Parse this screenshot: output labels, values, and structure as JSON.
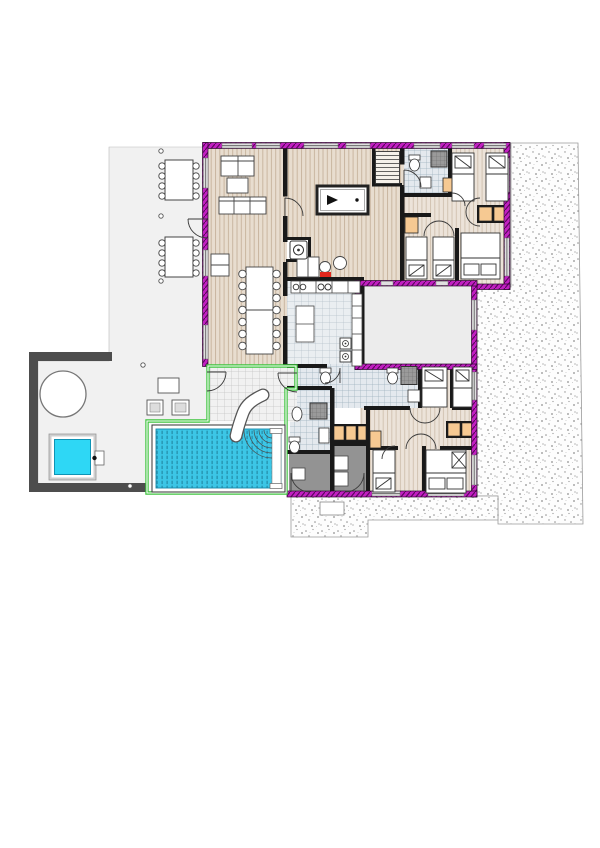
{
  "document": {
    "type": "architectural-floor-plan",
    "view": "top-down ground floor plan with surrounding site"
  },
  "colors": {
    "wood_base": "#e8ddcf",
    "wood_line": "#c9b6a0",
    "wood2_base": "#ece3d9",
    "wood2_line": "#d2c3b2",
    "tile_base": "#e4e9ee",
    "tile_line": "#9db0bd",
    "tilek_base": "#eaeef1",
    "tilek_line": "#b5c1ca",
    "deck_base": "#f1f1f1",
    "deck_line": "#c3c3c3",
    "pool": "#3cc6e6",
    "pool_dash": "#1f7f9b",
    "pool_edge": "#1888a8",
    "hot_tub": "#2ed7f5",
    "green": "#3ec43e",
    "magenta": "#c21fc2",
    "magenta_dark": "#59085c",
    "wall": "#191919",
    "patio": "#f1f1f1",
    "fence": "#4d4d4d",
    "gravel_dot": "#8f8f8f",
    "gravel_bg": "#fdfdfd",
    "orange": "#f6c992",
    "red": "#e3271d",
    "dark_room": "#939393",
    "gray_room": "#ececec",
    "fixture": "#ffffff",
    "line": "#333333"
  },
  "site": {
    "areas": [
      "gravel-terrain-east",
      "gravel-apron-south",
      "patio-west",
      "pool-enclosure",
      "main-house"
    ]
  },
  "rooms": [
    {
      "name": "living-room",
      "floor": "wood",
      "furniture": [
        "sofa",
        "loveseat",
        "coffee-table",
        "sideboard",
        "dining-table-14-seats"
      ]
    },
    {
      "name": "billiard-room",
      "floor": "wood",
      "furniture": [
        "billiard-table",
        "staircase",
        "desk",
        "round-table"
      ]
    },
    {
      "name": "laundry-wc",
      "floor": "white",
      "furniture": [
        "washing-machine"
      ]
    },
    {
      "name": "kitchen",
      "floor": "tile",
      "furniture": [
        "counter-with-sink-and-hob",
        "island",
        "tall-units",
        "double-oven"
      ]
    },
    {
      "name": "bathroom-north",
      "floor": "tile",
      "furniture": [
        "shower",
        "toilet",
        "sink"
      ]
    },
    {
      "name": "bedroom-ne-1",
      "floor": "wood",
      "beds": 2
    },
    {
      "name": "bedroom-ne-2",
      "floor": "wood",
      "beds": 2
    },
    {
      "name": "bedroom-ne-3",
      "floor": "wood",
      "beds": 1,
      "bed_type": "double"
    },
    {
      "name": "unassigned-gray-room",
      "floor": "plain"
    },
    {
      "name": "bathroom-center",
      "floor": "tile",
      "furniture": [
        "shower",
        "toilet",
        "toilet",
        "sink"
      ]
    },
    {
      "name": "bathroom-pool",
      "floor": "tile",
      "furniture": [
        "shower",
        "toilet",
        "sink",
        "cabinet"
      ]
    },
    {
      "name": "storage-left",
      "floor": "dark"
    },
    {
      "name": "storage-right",
      "floor": "dark",
      "furniture": [
        "shelves"
      ]
    },
    {
      "name": "bedroom-se-1",
      "floor": "wood",
      "beds": 2
    },
    {
      "name": "bedroom-se-2",
      "floor": "wood",
      "beds": 1
    },
    {
      "name": "bedroom-se-3",
      "floor": "wood",
      "beds": 1,
      "bed_type": "double"
    },
    {
      "name": "pool-hall",
      "floor": "deck-tile",
      "furniture": [
        "swimming-pool",
        "water-slide",
        "pool-bench"
      ]
    }
  ],
  "outdoor": {
    "patio_furniture": [
      "outdoor-table-8-seats",
      "outdoor-table-8-seats",
      "round-table",
      "hot-tub",
      "side-table",
      "two-lounge-chairs"
    ],
    "pool": {
      "color": "#3cc6e6",
      "slide": true,
      "ripples": true
    },
    "hot_tub_color": "#2ed7f5"
  },
  "wall_legend": {
    "exterior": "magenta hatched band",
    "interior": "solid black",
    "glazed_pool_enclosure": "green double line",
    "site_fence": "dark gray"
  }
}
